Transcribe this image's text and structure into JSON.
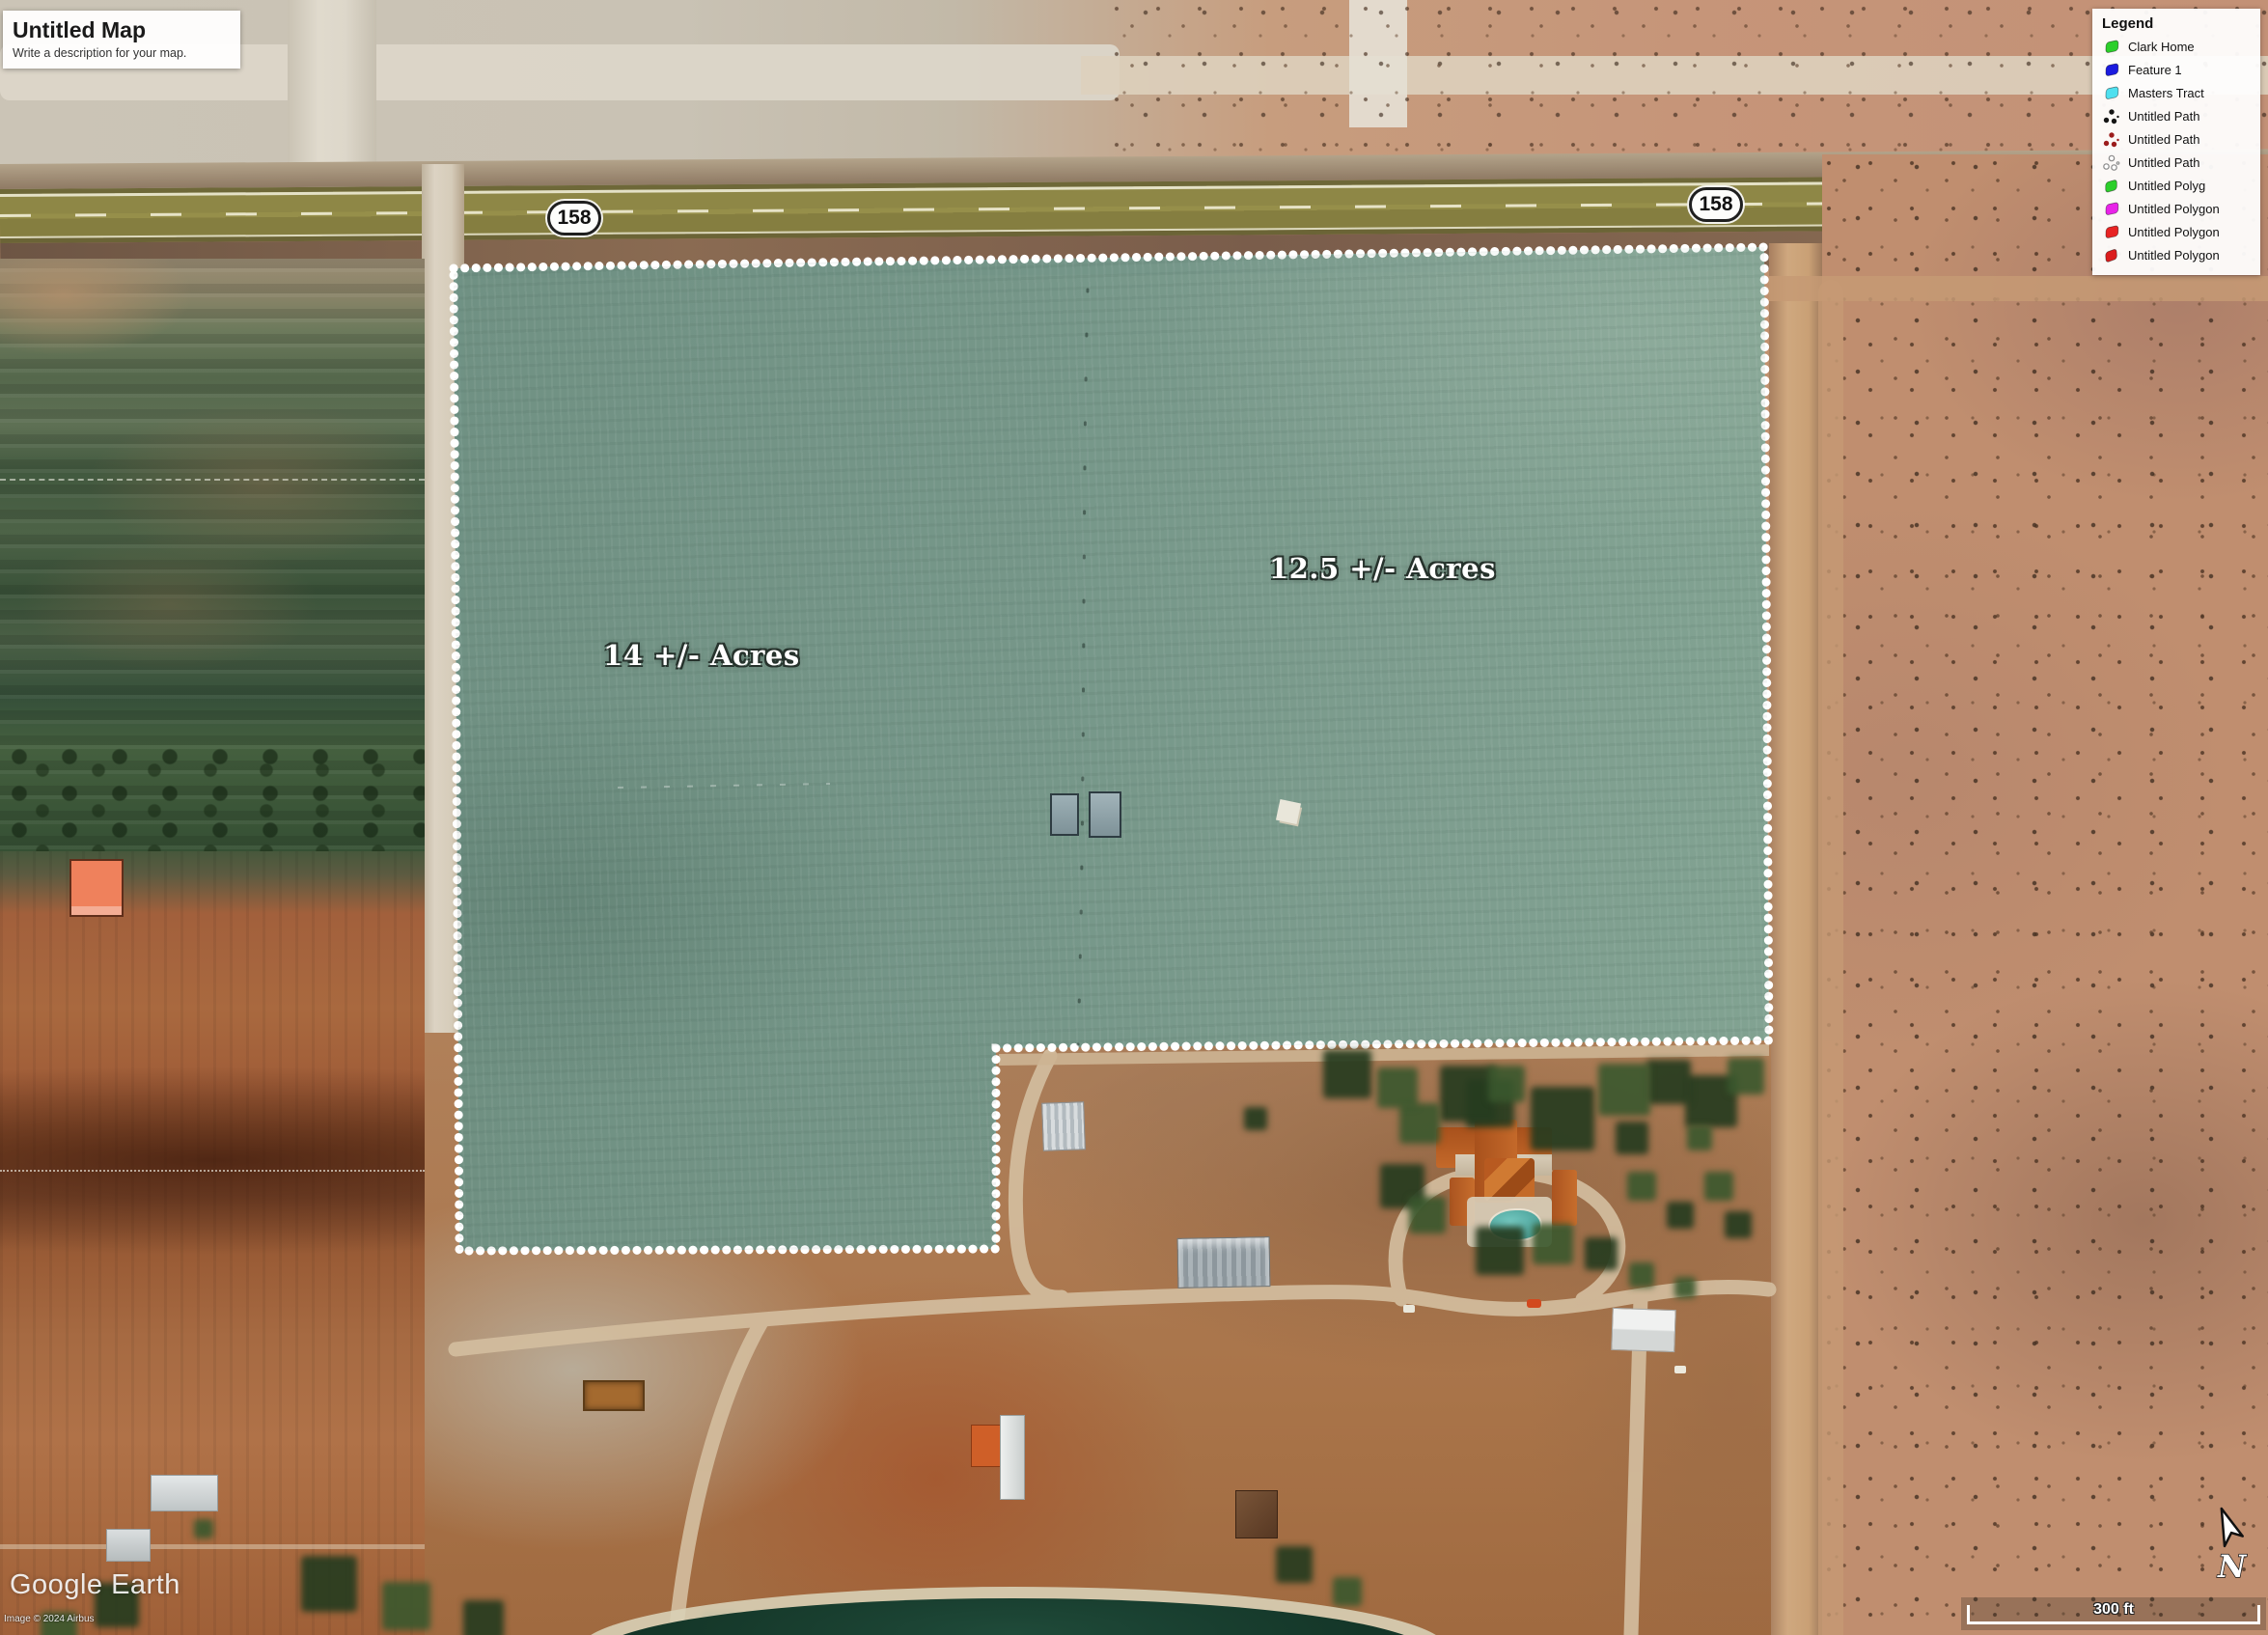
{
  "title_box": {
    "title": "Untitled Map",
    "description": "Write a description for your map."
  },
  "legend": {
    "title": "Legend",
    "items": [
      {
        "label": "Clark Home",
        "color": "#2ccf2b",
        "icon": "polygon-swatch-icon"
      },
      {
        "label": "Feature 1",
        "color": "#1b1bdf",
        "icon": "polygon-swatch-icon"
      },
      {
        "label": "Masters Tract",
        "color": "#4fe0ef",
        "icon": "polygon-swatch-icon"
      },
      {
        "label": "Untitled Path",
        "color": "#151515",
        "icon": "path-dots-icon"
      },
      {
        "label": "Untitled Path",
        "color": "#9c1c1c",
        "icon": "path-dots-icon"
      },
      {
        "label": "Untitled Path",
        "color": "#ffffff",
        "icon": "path-dots-outline-icon"
      },
      {
        "label": "Untitled Polyg",
        "color": "#2ccf2b",
        "icon": "polygon-swatch-icon"
      },
      {
        "label": "Untitled Polygon",
        "color": "#e823e8",
        "icon": "polygon-swatch-icon"
      },
      {
        "label": "Untitled Polygon",
        "color": "#e82323",
        "icon": "polygon-swatch-icon"
      },
      {
        "label": "Untitled Polygon",
        "color": "#db1d1d",
        "icon": "polygon-swatch-icon"
      }
    ]
  },
  "shields": [
    {
      "text": "158"
    },
    {
      "text": "158"
    }
  ],
  "area_labels": [
    {
      "text": "14 +/- Acres"
    },
    {
      "text": "12.5 +/- Acres"
    }
  ],
  "scale": {
    "label": "300 ft"
  },
  "north": {
    "label": "N",
    "icon": "north-arrow-icon"
  },
  "watermark": {
    "logo": "Google Earth",
    "attribution": "Image © 2024 Airbus"
  },
  "map": {
    "tract_fill_color": "#74988b",
    "tract_border_color": "#ffffff",
    "highway_color": "#8e8746"
  }
}
